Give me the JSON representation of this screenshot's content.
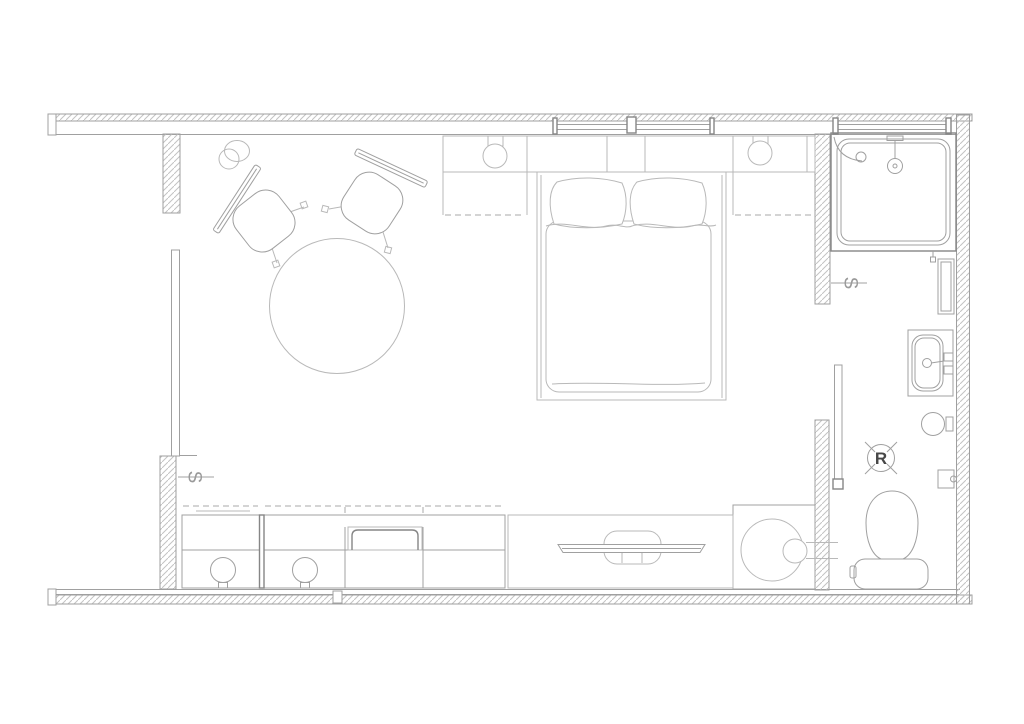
{
  "drawing": {
    "description": "Architectural floor plan line drawing of a studio hotel room with bedroom, bathroom and kitchenette counter",
    "colors": {
      "background": "#ffffff",
      "line_light": "#b9b9b9",
      "line": "#a0a0a0",
      "line_dark": "#868686",
      "label_text": "#474747"
    },
    "labels": {
      "r_marker": "R",
      "switch_entry": "S",
      "switch_bathroom": "S"
    },
    "elements": [
      "exterior-walls",
      "window",
      "entry-sliding-door",
      "wall-light",
      "dining-table",
      "chair",
      "chair",
      "bedside-console-left",
      "table-lamp",
      "headboard",
      "bedside-console-right",
      "double-bed",
      "pillows",
      "duvet",
      "bathroom-sliding-door",
      "shower",
      "shower-head",
      "hand-shower",
      "wall-cabinet",
      "washbasin",
      "faucet",
      "towel-ring",
      "r-marker",
      "toilet-paper-holder",
      "toilet",
      "washing-machine",
      "tv-console",
      "television",
      "kitchenette-counter",
      "sink-tray",
      "stool",
      "stool",
      "switch-symbol",
      "switch-symbol"
    ]
  }
}
